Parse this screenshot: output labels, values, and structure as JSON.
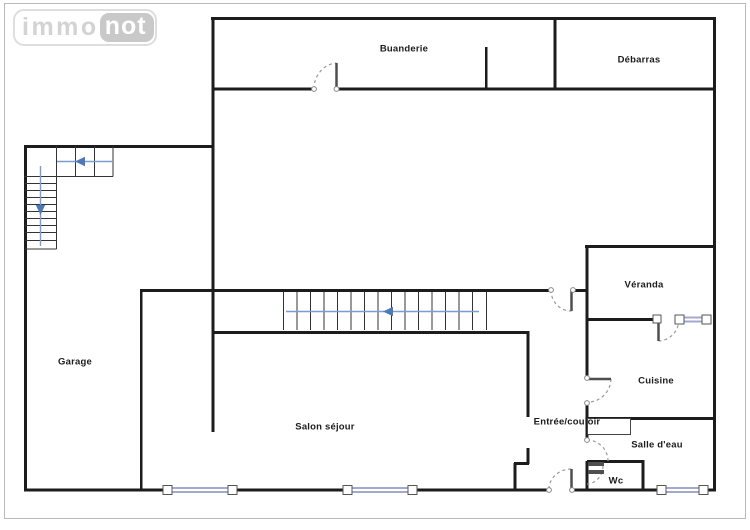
{
  "logo": {
    "immo": "immo",
    "not": "not"
  },
  "rooms": {
    "buanderie": "Buanderie",
    "debarras": "Débarras",
    "garage": "Garage",
    "veranda": "Véranda",
    "cuisine": "Cuisine",
    "salon_sejour": "Salon séjour",
    "entree_couloir": "Entrée/couloir",
    "salle_eau": "Salle d'eau",
    "wc": "Wc"
  },
  "icons": {
    "stairs_arrow_left": "left-arrow",
    "stairs_arrow_down": "down-arrow"
  },
  "colors": {
    "wall": "#1c1c1c",
    "thin_line": "#333333",
    "door_leaf": "#4f4f4f",
    "door_arc": "#999999",
    "window_glazing": "#a3a8cf",
    "stair_guide": "#7b9cd0",
    "stair_arrow": "#4d79b8",
    "logo_gray": "#c9c9c9",
    "frame_border": "#b9b9b9"
  }
}
